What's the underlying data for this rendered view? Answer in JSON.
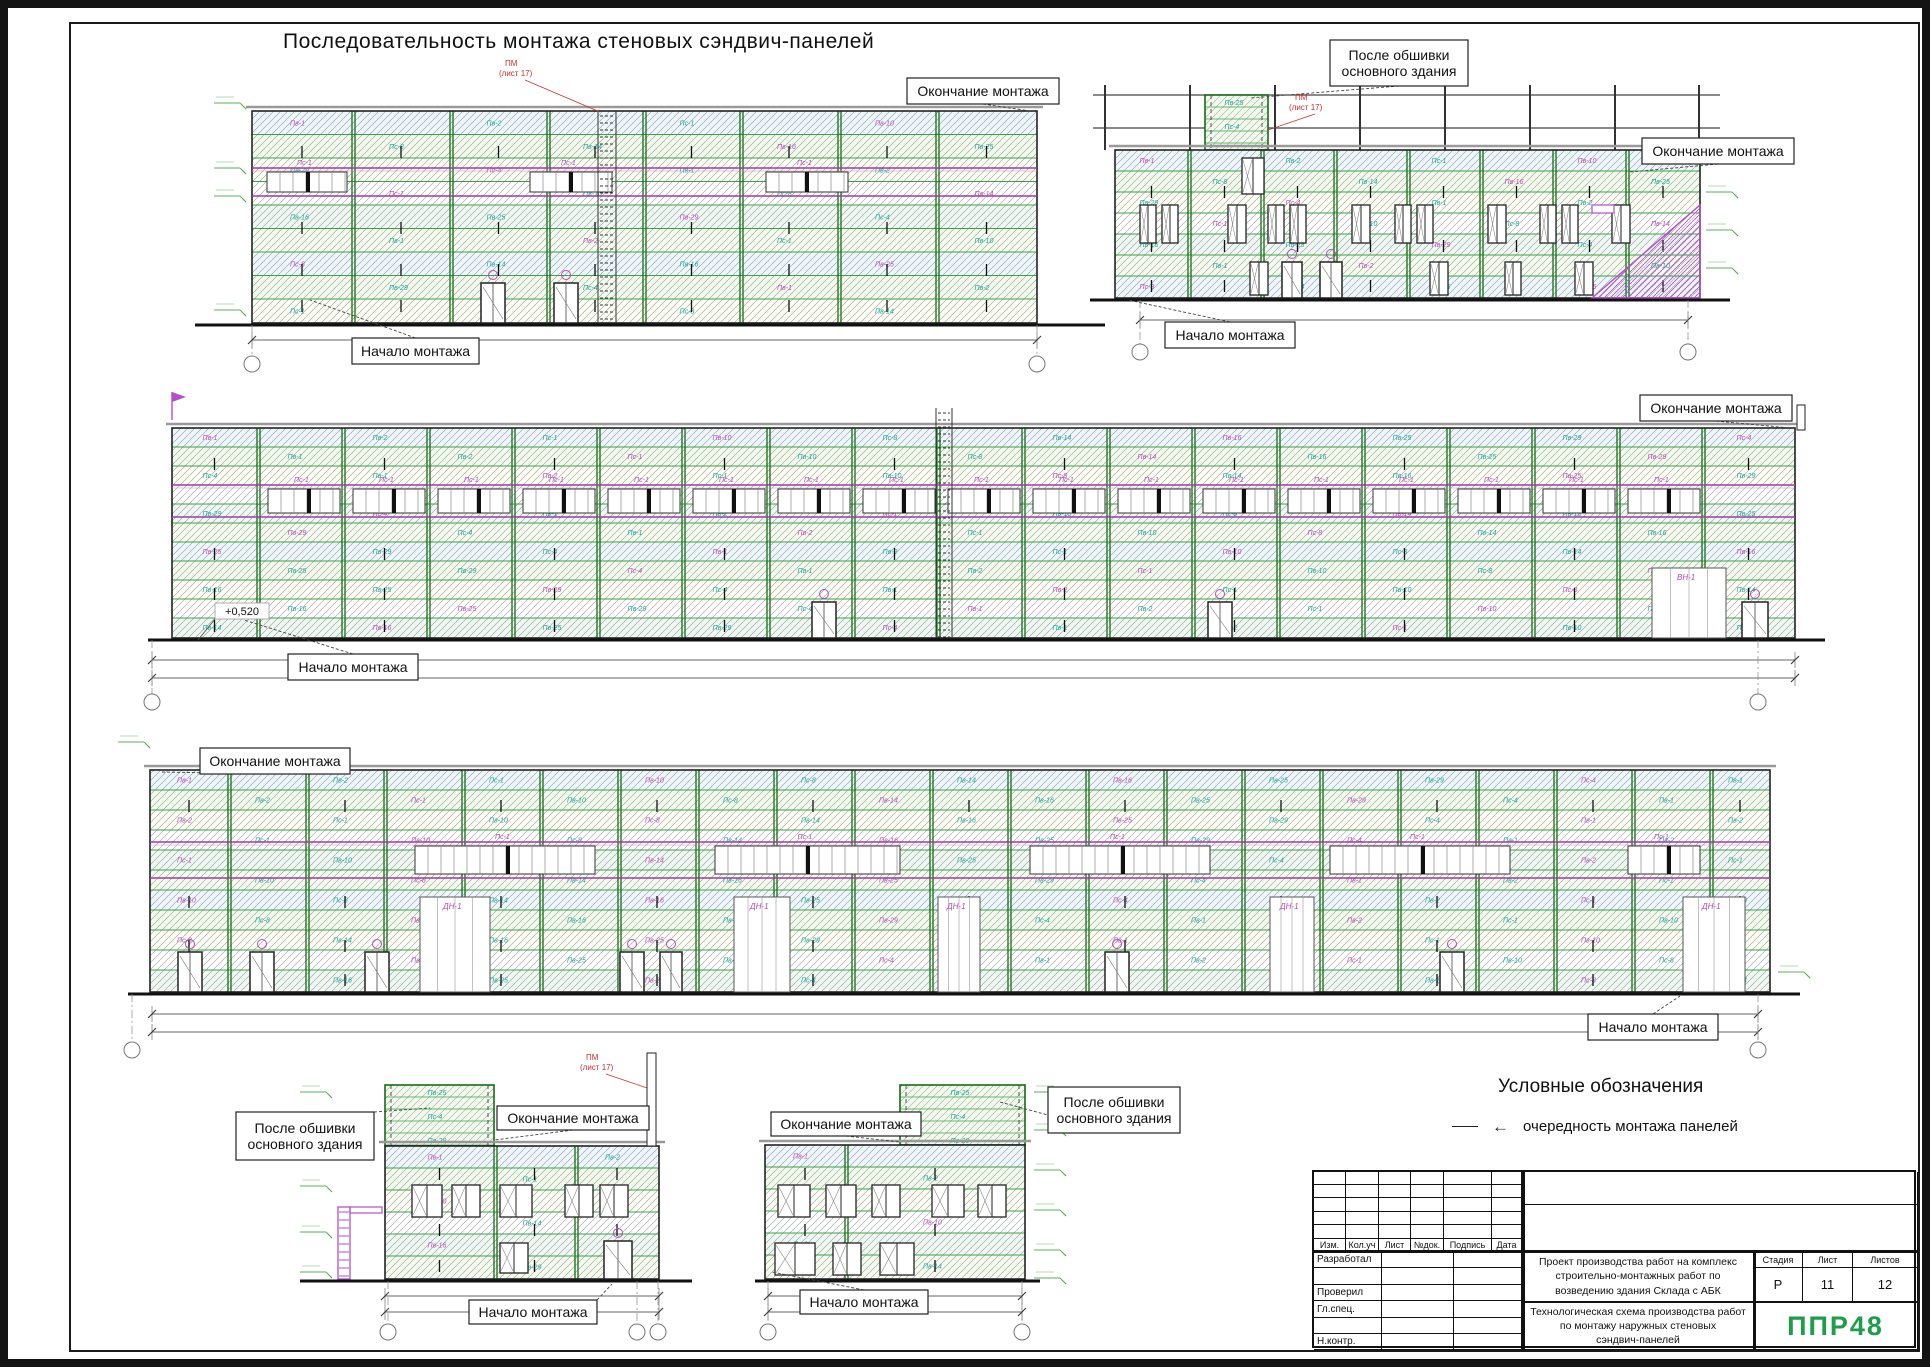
{
  "sheet_title": "Последовательность монтажа стеновых сэндвич-панелей",
  "labels": {
    "start": "Начало монтажа",
    "end": "Окончание монтажа",
    "after_line1": "После обшивки",
    "after_line2": "основного здания"
  },
  "elevation_mark": "+0,520",
  "mast_callout": {
    "line1": "ПМ",
    "line2": "(лист 17)"
  },
  "gate_labels": {
    "dn": "ДН-1",
    "vn": "ВН-1"
  },
  "band_label": "Пс-1",
  "panel_labels": [
    "Пв-1",
    "Пв-2",
    "Пс-1",
    "Пв-10",
    "Пс-8",
    "Пв-14",
    "Пв-16",
    "Пв-25",
    "Пв-29",
    "Пс-4"
  ],
  "legend": {
    "title": "Условные обозначения",
    "item": "очередность монтажа панелей"
  },
  "titleblock": {
    "header_cols": [
      "Изм.",
      "Кол.уч",
      "Лист",
      "№док.",
      "Подпись",
      "Дата"
    ],
    "roles": [
      "Разработал",
      "Проверил",
      "Гл.спец.",
      "Н.контр."
    ],
    "project_line1": "Проект производства работ на комплекс",
    "project_line2": "строительно-монтажных работ по",
    "project_line3": "возведению здания Склада с АБК",
    "doc_line1": "Технологическая схема производства работ",
    "doc_line2": "по монтажу наружных стеновых",
    "doc_line3": "сэндвич-панелей",
    "stage_label": "Стадия",
    "sheet_label": "Лист",
    "sheets_label": "Листов",
    "stage": "Р",
    "sheet": "11",
    "sheets": "12",
    "logo": "ППР48"
  },
  "colors": {
    "accent_green": "#1e9e4a",
    "line_green": "#3da04b",
    "column_green": "#166b16",
    "purple": "#a03aa6",
    "teal": "#1fa39a",
    "magenta": "#b84ab8",
    "red": "#c23030"
  }
}
